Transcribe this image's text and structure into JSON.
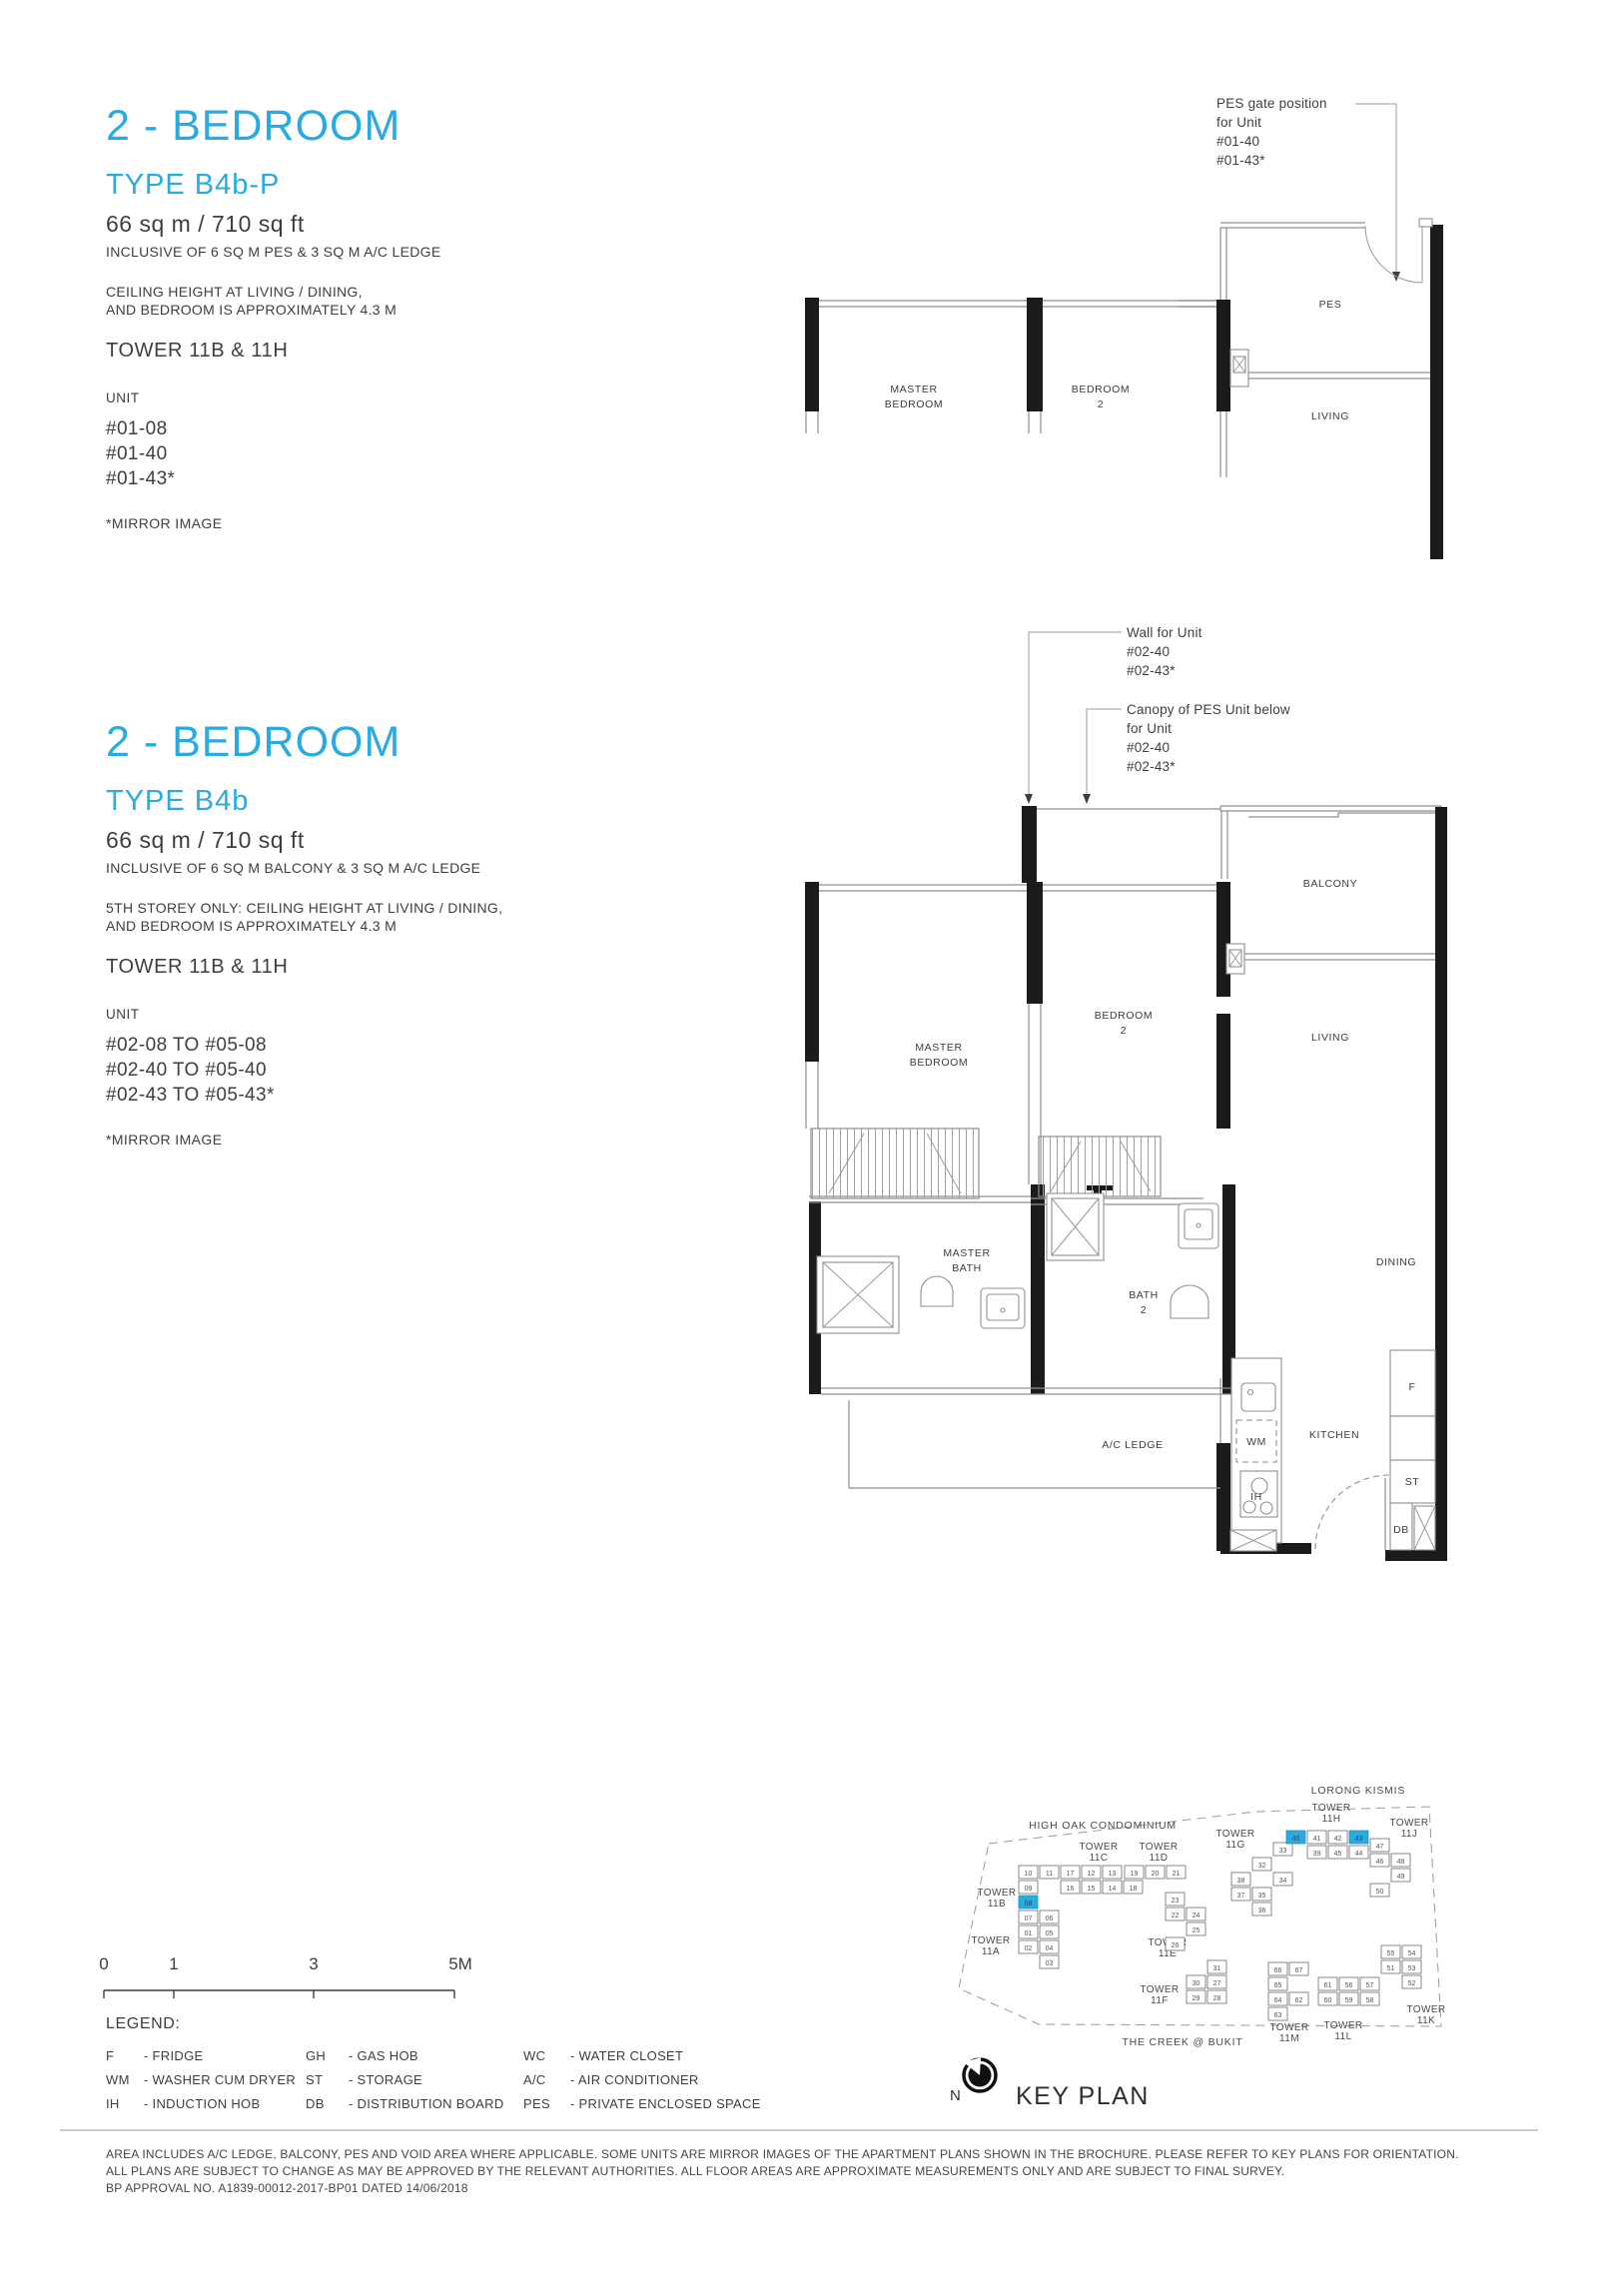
{
  "colors": {
    "accent": "#29ABE2",
    "ink": "#3e3e3e",
    "wall": "#1b1b1b",
    "line": "#8f8f8f"
  },
  "plan_top": {
    "title": "2 - BEDROOM",
    "type": "TYPE B4b-P",
    "area": "66 sq m / 710 sq ft",
    "inclusive": "INCLUSIVE OF 6 SQ M PES & 3 SQ M A/C LEDGE",
    "ceiling": [
      "CEILING HEIGHT AT LIVING / DINING,",
      "AND BEDROOM IS APPROXIMATELY 4.3 M"
    ],
    "tower": "TOWER 11B & 11H",
    "unit_label": "UNIT",
    "units": [
      "#01-08",
      "#01-40",
      "#01-43*"
    ],
    "mirror_note": "*MIRROR IMAGE",
    "annotation_pes_gate": [
      "PES gate position",
      "for Unit",
      "#01-40",
      "#01-43*"
    ],
    "rooms": {
      "master_1": "MASTER",
      "master_2": "BEDROOM",
      "bedroom2_1": "BEDROOM",
      "bedroom2_2": "2",
      "pes": "PES",
      "living": "LIVING"
    }
  },
  "plan_main": {
    "title": "2 - BEDROOM",
    "type": "TYPE B4b",
    "area": "66 sq m / 710 sq ft",
    "inclusive": "INCLUSIVE OF 6 SQ M BALCONY & 3 SQ M A/C LEDGE",
    "ceiling": [
      "5TH STOREY ONLY: CEILING HEIGHT AT LIVING / DINING,",
      "AND BEDROOM IS APPROXIMATELY 4.3 M"
    ],
    "tower": "TOWER 11B & 11H",
    "unit_label": "UNIT",
    "units": [
      "#02-08 TO #05-08",
      "#02-40 TO #05-40",
      "#02-43 TO #05-43*"
    ],
    "mirror_note": "*MIRROR IMAGE",
    "annotation_wall": [
      "Wall for Unit",
      "#02-40",
      "#02-43*"
    ],
    "annotation_canopy": [
      "Canopy of PES Unit below",
      "for Unit",
      "#02-40",
      "#02-43*"
    ],
    "rooms": {
      "master_1": "MASTER",
      "master_2": "BEDROOM",
      "bedroom2_1": "BEDROOM",
      "bedroom2_2": "2",
      "balcony": "BALCONY",
      "living": "LIVING",
      "dining": "DINING",
      "master_bath_1": "MASTER",
      "master_bath_2": "BATH",
      "bath2_1": "BATH",
      "bath2_2": "2",
      "ac_ledge": "A/C LEDGE",
      "kitchen": "KITCHEN"
    },
    "fixtures": {
      "wm": "WM",
      "ih": "IH",
      "fridge": "F",
      "storage": "ST",
      "db": "DB"
    }
  },
  "scale_bar": {
    "labels": [
      "0",
      "1",
      "3",
      "5M"
    ]
  },
  "legend": {
    "title": "LEGEND:",
    "items": [
      {
        "abbr": "F",
        "desc": "- FRIDGE"
      },
      {
        "abbr": "GH",
        "desc": "- GAS HOB"
      },
      {
        "abbr": "WC",
        "desc": "- WATER CLOSET"
      },
      {
        "abbr": "WM",
        "desc": "- WASHER CUM DRYER"
      },
      {
        "abbr": "ST",
        "desc": "- STORAGE"
      },
      {
        "abbr": "A/C",
        "desc": "- AIR CONDITIONER"
      },
      {
        "abbr": "IH",
        "desc": "- INDUCTION HOB"
      },
      {
        "abbr": "DB",
        "desc": "- DISTRIBUTION BOARD"
      },
      {
        "abbr": "PES",
        "desc": "- PRIVATE ENCLOSED SPACE"
      }
    ]
  },
  "key_plan": {
    "title": "KEY PLAN",
    "north": "N",
    "street_top": "LORONG KISMIS",
    "neighbor_left": "HIGH OAK CONDOMINIUM",
    "neighbor_bottom": "THE CREEK @ BUKIT",
    "highlight_color": "#29ABE2",
    "highlighted_units": [
      "08",
      "40",
      "43"
    ],
    "towers": [
      {
        "name": "TOWER 11B",
        "rows": [
          [
            "10",
            "11"
          ],
          [
            "09",
            ""
          ],
          [
            "08",
            ""
          ],
          [
            "07",
            "06"
          ],
          [
            "01",
            "05"
          ],
          [
            "02",
            "04"
          ],
          [
            "",
            "03"
          ]
        ]
      },
      {
        "name": "TOWER 11A",
        "rows": []
      },
      {
        "name": "TOWER 11C",
        "rows": [
          [
            "17",
            "12",
            "13"
          ],
          [
            "16",
            "15",
            "14",
            "18"
          ]
        ]
      },
      {
        "name": "TOWER 11D",
        "rows": [
          [
            "19",
            "20",
            "21"
          ]
        ]
      },
      {
        "name": "TOWER 11E",
        "rows": [
          [
            "23",
            ""
          ],
          [
            "22",
            "24"
          ],
          [
            "",
            "25"
          ],
          [
            "26",
            ""
          ]
        ]
      },
      {
        "name": "TOWER 11F",
        "rows": [
          [
            "",
            "31"
          ],
          [
            "30",
            "27"
          ],
          [
            "29",
            "28"
          ]
        ]
      },
      {
        "name": "TOWER 11G",
        "rows": [
          [
            "",
            "",
            "33"
          ],
          [
            "",
            "32",
            ""
          ],
          [
            "38",
            "",
            "34"
          ],
          [
            "37",
            "35",
            ""
          ],
          [
            "",
            "36",
            ""
          ]
        ]
      },
      {
        "name": "TOWER 11H",
        "rows": [
          [
            "40",
            "41",
            "42",
            "43"
          ],
          [
            "",
            "39",
            "45",
            "44"
          ]
        ]
      },
      {
        "name": "TOWER 11J",
        "rows": [
          [
            "47",
            ""
          ],
          [
            "46",
            "48"
          ],
          [
            "",
            "49"
          ],
          [
            "50",
            ""
          ]
        ]
      },
      {
        "name": "TOWER 11K",
        "rows": [
          [
            "55",
            "54"
          ],
          [
            "51",
            "53"
          ],
          [
            "",
            "52"
          ]
        ]
      },
      {
        "name": "TOWER 11L",
        "rows": [
          [
            "61",
            "56",
            "57"
          ],
          [
            "60",
            "59",
            "58"
          ]
        ]
      },
      {
        "name": "TOWER 11M",
        "rows": [
          [
            "66",
            "67"
          ],
          [
            "65",
            ""
          ],
          [
            "64",
            "62"
          ],
          [
            "63",
            ""
          ]
        ]
      }
    ]
  },
  "footer": {
    "lines": [
      "AREA INCLUDES A/C LEDGE, BALCONY, PES AND VOID AREA WHERE APPLICABLE. SOME UNITS ARE MIRROR IMAGES OF THE APARTMENT PLANS SHOWN IN THE BROCHURE. PLEASE REFER TO KEY PLANS FOR ORIENTATION.",
      "ALL PLANS ARE SUBJECT TO CHANGE AS MAY BE APPROVED BY THE RELEVANT AUTHORITIES. ALL FLOOR AREAS ARE APPROXIMATE MEASUREMENTS ONLY AND ARE SUBJECT TO FINAL SURVEY.",
      "BP APPROVAL NO. A1839-00012-2017-BP01 DATED 14/06/2018"
    ]
  }
}
